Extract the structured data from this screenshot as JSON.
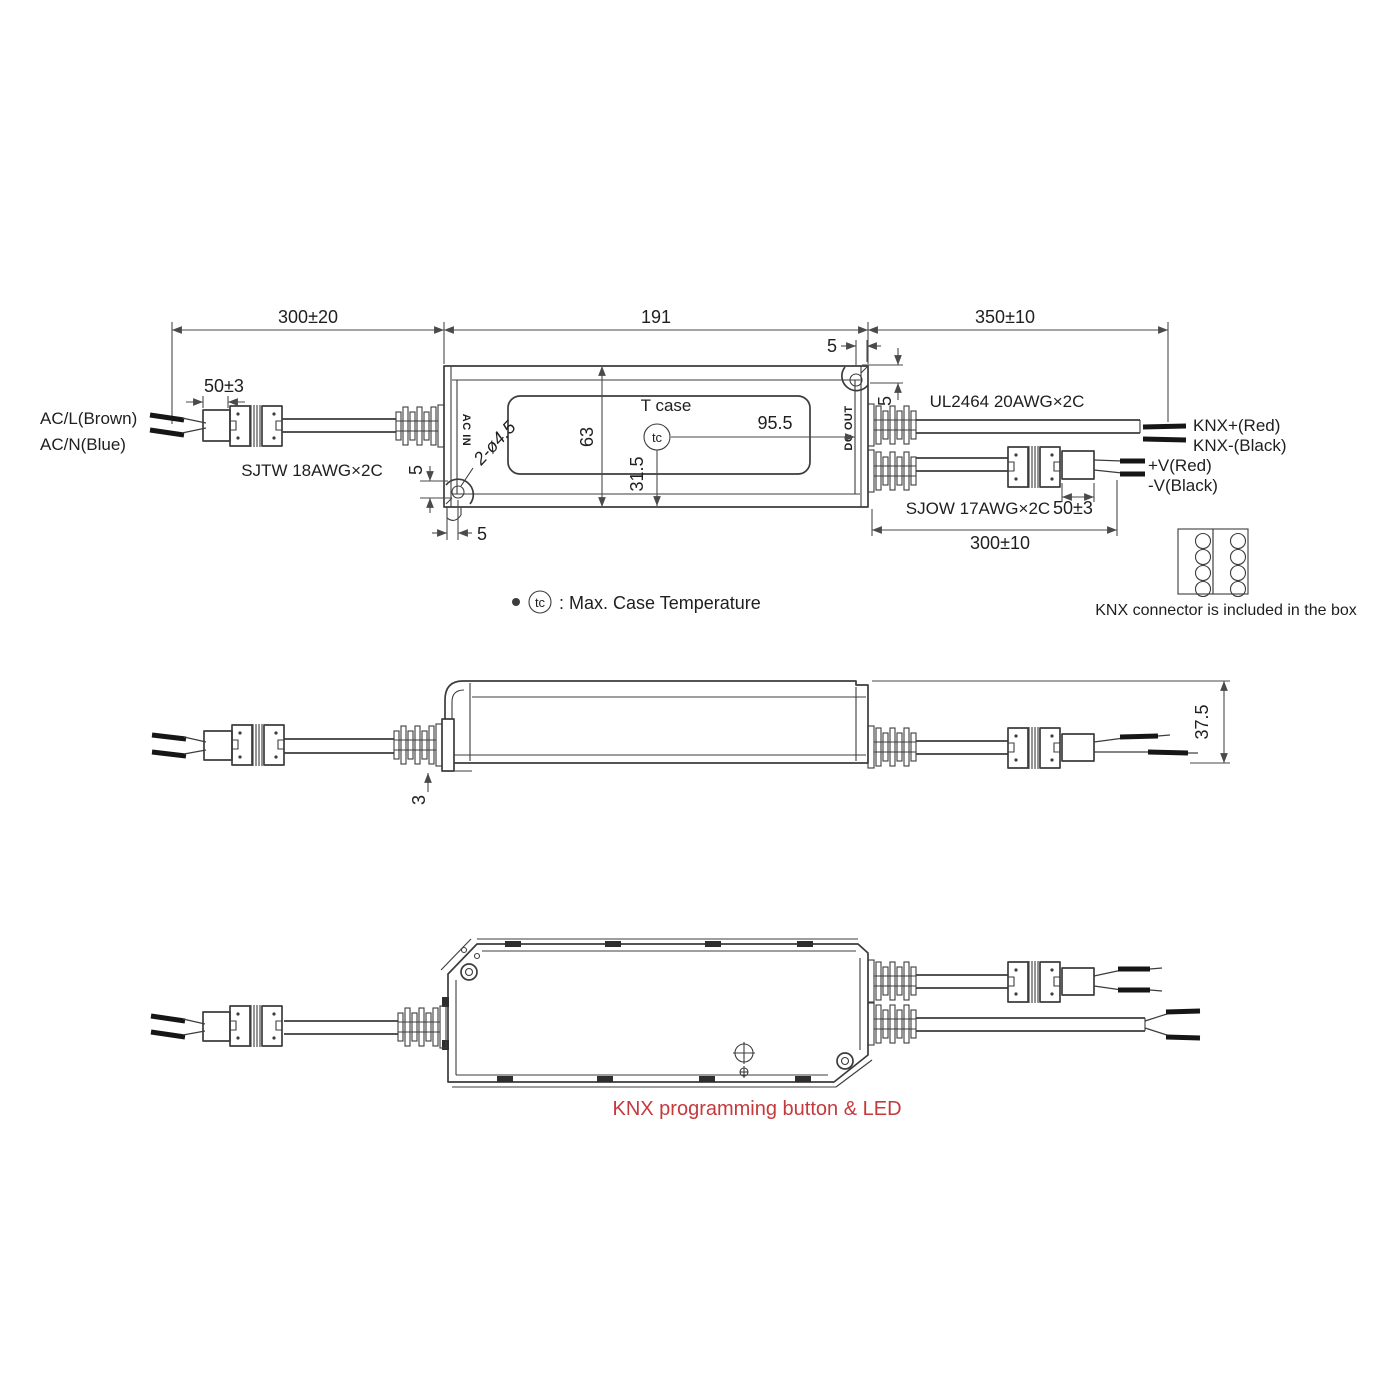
{
  "title": "LED driver mechanical drawing",
  "colors": {
    "line": "#3c3c3c",
    "dimension": "#4a4a4a",
    "text": "#1f1f1f",
    "accent_red": "#c5393c",
    "wire": "#161616",
    "background": "#ffffff"
  },
  "top": {
    "dim_cable_in": "300±20",
    "dim_case": "191",
    "dim_cable_out": "350±10",
    "dim_conn_in": "50±3",
    "label_acl": "AC/L(Brown)",
    "label_acn": "AC/N(Blue)",
    "label_cable_in": "SJTW 18AWG×2C",
    "port_in": "AC IN",
    "port_out": "DC OUT",
    "tcase_title": "T case",
    "tc": "tc",
    "dim_tc_offset": "95.5",
    "dim_width": "63",
    "dim_tc_height": "31.5",
    "dim_holes": "2-ø4.5",
    "dim_ear_a": "5",
    "dim_ear_b": "5",
    "dim_ear_c": "5",
    "dim_ear_d": "5",
    "label_cable_knx": "UL2464 20AWG×2C",
    "label_knx_plus": "KNX+(Red)",
    "label_knx_minus": "KNX-(Black)",
    "label_v_plus": "+V(Red)",
    "label_v_minus": "-V(Black)",
    "label_cable_out": "SJOW 17AWG×2C",
    "dim_conn_out": "50±3",
    "dim_cable_out2": "300±10"
  },
  "notes": {
    "tc": "tc",
    "tc_text": ": Max. Case Temperature",
    "knx_text": "KNX connector is included in the box"
  },
  "side": {
    "dim_height": "37.5",
    "dim_flange": "3"
  },
  "bottom": {
    "caption": "KNX programming button & LED"
  }
}
